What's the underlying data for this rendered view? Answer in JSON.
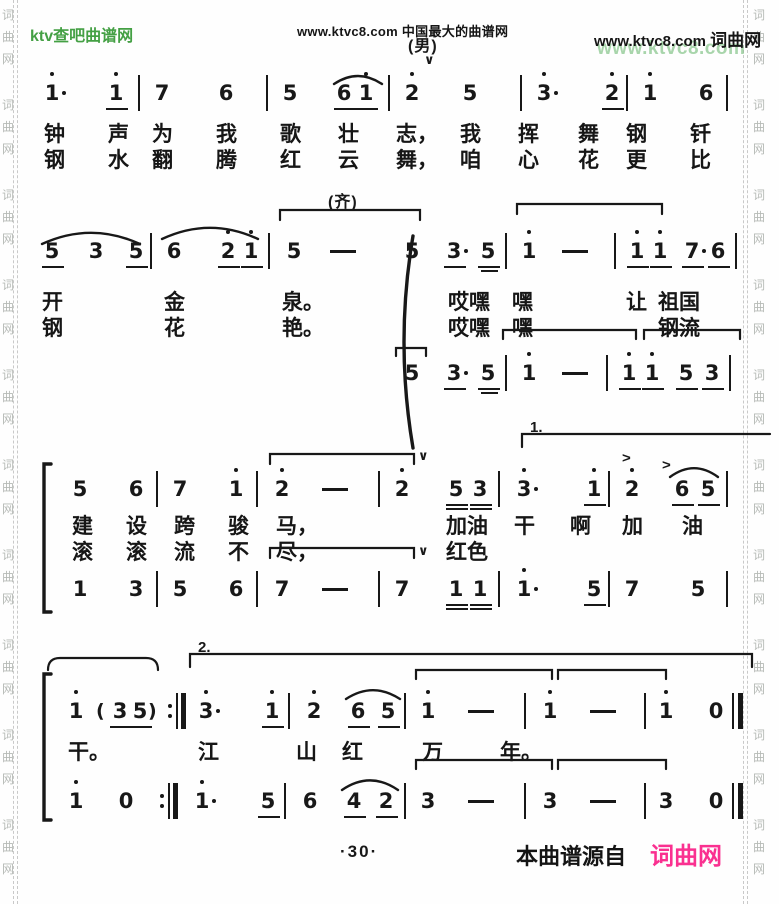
{
  "page": {
    "header": {
      "site_left": "ktv查吧曲谱网",
      "center": "www.ktvc8.com 中国最大的曲谱网",
      "right_url": "www.ktvc8.com",
      "right_site": "词曲网",
      "green_watermark": "www.ktvc8.com"
    },
    "footer": {
      "page_num": "·30·",
      "source_label": "本曲谱源自",
      "source_site": "词曲网"
    },
    "watermark_chars": [
      "词",
      "曲",
      "网"
    ],
    "glyphs": {
      "breath": "∨",
      "accent": ">"
    },
    "colors": {
      "green": "#44a044",
      "pink": "#fa3090",
      "ink": "#181818",
      "wm_green": "rgba(110,185,115,.6)",
      "wm_gray": "#b6bab6"
    }
  },
  "score": {
    "labels": [
      {
        "t": "(男)",
        "x": 408,
        "y": 32,
        "cls": "mlabel"
      },
      {
        "t": "(齐)",
        "x": 328,
        "y": 188,
        "cls": "mlabel"
      },
      {
        "t": "1.",
        "x": 530,
        "y": 419,
        "cls": "vlabel"
      },
      {
        "t": "2.",
        "x": 198,
        "y": 639,
        "cls": "vlabel"
      }
    ],
    "rows": [
      {
        "y": 82,
        "tokens": [
          {
            "x": 44,
            "g": "1",
            "hi": 1,
            "aug": 1
          },
          {
            "x": 108,
            "g": "1",
            "hi": 1,
            "ul": 1
          },
          {
            "x": 138,
            "g": "|"
          },
          {
            "x": 154,
            "g": "7"
          },
          {
            "x": 218,
            "g": "6"
          },
          {
            "x": 266,
            "g": "|"
          },
          {
            "x": 282,
            "g": "5"
          },
          {
            "x": 336,
            "g": "6",
            "ul": 1
          },
          {
            "x": 358,
            "g": "1",
            "hi": 1,
            "ul": 1
          },
          {
            "x": 388,
            "g": "|"
          },
          {
            "x": 404,
            "g": "2",
            "hi": 1
          },
          {
            "x": 462,
            "g": "5"
          },
          {
            "x": 520,
            "g": "|"
          },
          {
            "x": 536,
            "g": "3",
            "hi": 1,
            "aug": 1
          },
          {
            "x": 604,
            "g": "2",
            "hi": 1,
            "ul": 1
          },
          {
            "x": 626,
            "g": "|"
          },
          {
            "x": 642,
            "g": "1",
            "hi": 1
          },
          {
            "x": 698,
            "g": "6"
          },
          {
            "x": 726,
            "g": "|"
          }
        ]
      },
      {
        "y": 240,
        "tokens": [
          {
            "x": 44,
            "g": "5",
            "ul": 1
          },
          {
            "x": 88,
            "g": "3"
          },
          {
            "x": 128,
            "g": "5",
            "ul": 1
          },
          {
            "x": 150,
            "g": "|"
          },
          {
            "x": 166,
            "g": "6"
          },
          {
            "x": 220,
            "g": "2",
            "hi": 1,
            "ul": 1
          },
          {
            "x": 243,
            "g": "1",
            "hi": 1,
            "ul": 1
          },
          {
            "x": 268,
            "g": "|"
          },
          {
            "x": 286,
            "g": "5"
          },
          {
            "x": 330,
            "g": "-"
          },
          {
            "x": 404,
            "g": "5"
          },
          {
            "x": 446,
            "g": "3",
            "ul": 1,
            "aug": 1
          },
          {
            "x": 480,
            "g": "5",
            "ul": 1,
            "ul2": 1
          },
          {
            "x": 505,
            "g": "|"
          },
          {
            "x": 521,
            "g": "1",
            "hi": 1
          },
          {
            "x": 562,
            "g": "-"
          },
          {
            "x": 614,
            "g": "|"
          },
          {
            "x": 629,
            "g": "1",
            "hi": 1,
            "ul": 1
          },
          {
            "x": 652,
            "g": "1",
            "hi": 1,
            "ul": 1
          },
          {
            "x": 684,
            "g": "7",
            "ul": 1,
            "aug": 1
          },
          {
            "x": 710,
            "g": "6",
            "ul": 1
          },
          {
            "x": 735,
            "g": "|"
          }
        ]
      },
      {
        "y": 362,
        "tokens": [
          {
            "x": 404,
            "g": "5"
          },
          {
            "x": 446,
            "g": "3",
            "ul": 1,
            "aug": 1
          },
          {
            "x": 480,
            "g": "5",
            "ul": 1,
            "ul2": 1
          },
          {
            "x": 505,
            "g": "|"
          },
          {
            "x": 521,
            "g": "1",
            "hi": 1
          },
          {
            "x": 562,
            "g": "-"
          },
          {
            "x": 606,
            "g": "|"
          },
          {
            "x": 621,
            "g": "1",
            "hi": 1,
            "ul": 1
          },
          {
            "x": 644,
            "g": "1",
            "hi": 1,
            "ul": 1
          },
          {
            "x": 678,
            "g": "5",
            "ul": 1
          },
          {
            "x": 704,
            "g": "3",
            "ul": 1
          },
          {
            "x": 729,
            "g": "|"
          }
        ]
      },
      {
        "y": 478,
        "tokens": [
          {
            "x": 72,
            "g": "5"
          },
          {
            "x": 128,
            "g": "6"
          },
          {
            "x": 156,
            "g": "|"
          },
          {
            "x": 172,
            "g": "7"
          },
          {
            "x": 228,
            "g": "1",
            "hi": 1
          },
          {
            "x": 256,
            "g": "|"
          },
          {
            "x": 274,
            "g": "2",
            "hi": 1
          },
          {
            "x": 322,
            "g": "-"
          },
          {
            "x": 378,
            "g": "|"
          },
          {
            "x": 394,
            "g": "2",
            "hi": 1
          },
          {
            "x": 448,
            "g": "5",
            "ul": 2
          },
          {
            "x": 472,
            "g": "3",
            "ul": 2
          },
          {
            "x": 498,
            "g": "|"
          },
          {
            "x": 516,
            "g": "3",
            "hi": 1,
            "aug": 1
          },
          {
            "x": 586,
            "g": "1",
            "hi": 1,
            "ul": 1
          },
          {
            "x": 608,
            "g": "|"
          },
          {
            "x": 624,
            "g": "2",
            "hi": 1
          },
          {
            "x": 674,
            "g": "6",
            "ul": 1
          },
          {
            "x": 700,
            "g": "5",
            "ul": 1
          },
          {
            "x": 726,
            "g": "|"
          }
        ]
      },
      {
        "y": 578,
        "tokens": [
          {
            "x": 72,
            "g": "1"
          },
          {
            "x": 128,
            "g": "3"
          },
          {
            "x": 156,
            "g": "|"
          },
          {
            "x": 172,
            "g": "5"
          },
          {
            "x": 228,
            "g": "6"
          },
          {
            "x": 256,
            "g": "|"
          },
          {
            "x": 274,
            "g": "7"
          },
          {
            "x": 322,
            "g": "-"
          },
          {
            "x": 378,
            "g": "|"
          },
          {
            "x": 394,
            "g": "7"
          },
          {
            "x": 448,
            "g": "1",
            "ul": 2
          },
          {
            "x": 472,
            "g": "1",
            "ul": 2
          },
          {
            "x": 498,
            "g": "|"
          },
          {
            "x": 516,
            "g": "1",
            "hi": 1,
            "aug": 1
          },
          {
            "x": 586,
            "g": "5",
            "ul": 1
          },
          {
            "x": 608,
            "g": "|"
          },
          {
            "x": 624,
            "g": "7"
          },
          {
            "x": 690,
            "g": "5"
          },
          {
            "x": 726,
            "g": "|"
          }
        ]
      },
      {
        "y": 700,
        "tokens": [
          {
            "x": 68,
            "g": "1",
            "hi": 1
          },
          {
            "x": 96,
            "g": "("
          },
          {
            "x": 112,
            "g": "3",
            "ul": 1
          },
          {
            "x": 132,
            "g": "5",
            "ul": 1
          },
          {
            "x": 148,
            "g": ")"
          },
          {
            "x": 168,
            "g": "rep"
          },
          {
            "x": 198,
            "g": "3",
            "hi": 1,
            "aug": 1
          },
          {
            "x": 264,
            "g": "1",
            "hi": 1,
            "ul": 1
          },
          {
            "x": 288,
            "g": "|"
          },
          {
            "x": 306,
            "g": "2",
            "hi": 1
          },
          {
            "x": 350,
            "g": "6",
            "ul": 1
          },
          {
            "x": 380,
            "g": "5",
            "ul": 1
          },
          {
            "x": 404,
            "g": "|"
          },
          {
            "x": 420,
            "g": "1",
            "hi": 1
          },
          {
            "x": 468,
            "g": "-"
          },
          {
            "x": 524,
            "g": "|"
          },
          {
            "x": 542,
            "g": "1",
            "hi": 1
          },
          {
            "x": 590,
            "g": "-"
          },
          {
            "x": 644,
            "g": "|"
          },
          {
            "x": 658,
            "g": "1",
            "hi": 1
          },
          {
            "x": 708,
            "g": "0"
          },
          {
            "x": 732,
            "g": "end"
          }
        ]
      },
      {
        "y": 790,
        "tokens": [
          {
            "x": 68,
            "g": "1",
            "hi": 1
          },
          {
            "x": 118,
            "g": "0"
          },
          {
            "x": 160,
            "g": "rep"
          },
          {
            "x": 194,
            "g": "1",
            "hi": 1,
            "aug": 1
          },
          {
            "x": 260,
            "g": "5",
            "ul": 1
          },
          {
            "x": 284,
            "g": "|"
          },
          {
            "x": 302,
            "g": "6"
          },
          {
            "x": 346,
            "g": "4",
            "ul": 1
          },
          {
            "x": 378,
            "g": "2",
            "ul": 1
          },
          {
            "x": 404,
            "g": "|"
          },
          {
            "x": 420,
            "g": "3"
          },
          {
            "x": 468,
            "g": "-"
          },
          {
            "x": 524,
            "g": "|"
          },
          {
            "x": 542,
            "g": "3"
          },
          {
            "x": 590,
            "g": "-"
          },
          {
            "x": 644,
            "g": "|"
          },
          {
            "x": 658,
            "g": "3"
          },
          {
            "x": 708,
            "g": "0"
          },
          {
            "x": 732,
            "g": "end"
          }
        ]
      }
    ],
    "lyrics": [
      {
        "y": 118,
        "items": [
          {
            "x": 44,
            "t": "钟"
          },
          {
            "x": 108,
            "t": "声"
          },
          {
            "x": 152,
            "t": "为"
          },
          {
            "x": 216,
            "t": "我"
          },
          {
            "x": 280,
            "t": "歌"
          },
          {
            "x": 338,
            "t": "壮"
          },
          {
            "x": 396,
            "t": "志，"
          },
          {
            "x": 460,
            "t": "我"
          },
          {
            "x": 518,
            "t": "挥"
          },
          {
            "x": 578,
            "t": "舞"
          },
          {
            "x": 626,
            "t": "钢"
          },
          {
            "x": 690,
            "t": "钎"
          }
        ]
      },
      {
        "y": 144,
        "items": [
          {
            "x": 44,
            "t": "钢"
          },
          {
            "x": 108,
            "t": "水"
          },
          {
            "x": 152,
            "t": "翻"
          },
          {
            "x": 216,
            "t": "腾"
          },
          {
            "x": 280,
            "t": "红"
          },
          {
            "x": 338,
            "t": "云"
          },
          {
            "x": 396,
            "t": "舞，"
          },
          {
            "x": 460,
            "t": "咱"
          },
          {
            "x": 518,
            "t": "心"
          },
          {
            "x": 578,
            "t": "花"
          },
          {
            "x": 626,
            "t": "更"
          },
          {
            "x": 690,
            "t": "比"
          }
        ]
      },
      {
        "y": 286,
        "items": [
          {
            "x": 42,
            "t": "开"
          },
          {
            "x": 164,
            "t": "金"
          },
          {
            "x": 282,
            "t": "泉。"
          },
          {
            "x": 448,
            "t": "哎嘿"
          },
          {
            "x": 512,
            "t": "嘿"
          },
          {
            "x": 626,
            "t": "让"
          },
          {
            "x": 658,
            "t": "祖国"
          }
        ]
      },
      {
        "y": 312,
        "items": [
          {
            "x": 42,
            "t": "钢"
          },
          {
            "x": 164,
            "t": "花"
          },
          {
            "x": 282,
            "t": "艳。"
          },
          {
            "x": 448,
            "t": "哎嘿"
          },
          {
            "x": 512,
            "t": "嘿"
          },
          {
            "x": 658,
            "t": "钢流"
          }
        ]
      },
      {
        "y": 510,
        "items": [
          {
            "x": 72,
            "t": "建"
          },
          {
            "x": 126,
            "t": "设"
          },
          {
            "x": 174,
            "t": "跨"
          },
          {
            "x": 228,
            "t": "骏"
          },
          {
            "x": 276,
            "t": "马，"
          },
          {
            "x": 446,
            "t": "加油"
          },
          {
            "x": 514,
            "t": "干"
          },
          {
            "x": 570,
            "t": "啊"
          },
          {
            "x": 622,
            "t": "加"
          },
          {
            "x": 682,
            "t": "油"
          }
        ]
      },
      {
        "y": 536,
        "items": [
          {
            "x": 72,
            "t": "滚"
          },
          {
            "x": 126,
            "t": "滚"
          },
          {
            "x": 174,
            "t": "流"
          },
          {
            "x": 228,
            "t": "不"
          },
          {
            "x": 276,
            "t": "尽，"
          },
          {
            "x": 446,
            "t": "红色"
          }
        ]
      },
      {
        "y": 736,
        "items": [
          {
            "x": 68,
            "t": "干。"
          },
          {
            "x": 198,
            "t": "江"
          },
          {
            "x": 296,
            "t": "山"
          },
          {
            "x": 342,
            "t": "红"
          },
          {
            "x": 422,
            "t": "万"
          },
          {
            "x": 500,
            "t": "年。"
          }
        ]
      }
    ],
    "graphics": {
      "slurs": [
        {
          "x1": 334,
          "x2": 382,
          "y": 74,
          "h": 10
        },
        {
          "x1": 42,
          "x2": 140,
          "y": 230,
          "h": 14
        },
        {
          "x1": 162,
          "x2": 258,
          "y": 225,
          "h": 14
        },
        {
          "x1": 670,
          "x2": 718,
          "y": 466,
          "h": 11
        },
        {
          "x1": 346,
          "x2": 400,
          "y": 688,
          "h": 11
        },
        {
          "x1": 342,
          "x2": 398,
          "y": 778,
          "h": 12
        }
      ],
      "brackets": [
        {
          "x1": 280,
          "x2": 420,
          "y": 210,
          "h": 10
        },
        {
          "x1": 517,
          "x2": 662,
          "y": 204,
          "h": 10
        },
        {
          "x1": 396,
          "x2": 426,
          "y": 348,
          "h": 8
        },
        {
          "x1": 503,
          "x2": 636,
          "y": 330,
          "h": 9
        },
        {
          "x1": 644,
          "x2": 740,
          "y": 330,
          "h": 9
        },
        {
          "x1": 270,
          "x2": 414,
          "y": 454,
          "h": 10
        },
        {
          "x1": 270,
          "x2": 414,
          "y": 548,
          "h": 10
        },
        {
          "x1": 416,
          "x2": 552,
          "y": 670,
          "h": 9
        },
        {
          "x1": 558,
          "x2": 666,
          "y": 670,
          "h": 9
        },
        {
          "x1": 416,
          "x2": 552,
          "y": 760,
          "h": 9
        },
        {
          "x1": 558,
          "x2": 666,
          "y": 760,
          "h": 9
        }
      ],
      "rbrackets": [
        {
          "x1": 48,
          "x2": 158,
          "y": 658,
          "h": 12
        }
      ],
      "voltas": [
        {
          "x1": 522,
          "x2": 770,
          "y": 434,
          "tickR": 0
        },
        {
          "x1": 190,
          "x2": 752,
          "y": 654,
          "tickR": 1
        }
      ],
      "braces": [
        {
          "x": 404,
          "y1": 236,
          "y2": 448
        }
      ],
      "sysbrackets": [
        {
          "x": 44,
          "y1": 464,
          "y2": 612
        },
        {
          "x": 44,
          "y1": 674,
          "y2": 820
        }
      ],
      "breaths": [
        {
          "x": 424,
          "y": 52
        },
        {
          "x": 418,
          "y": 448
        },
        {
          "x": 418,
          "y": 543
        }
      ],
      "accents": [
        {
          "x": 622,
          "y": 450
        },
        {
          "x": 662,
          "y": 457
        }
      ]
    }
  }
}
